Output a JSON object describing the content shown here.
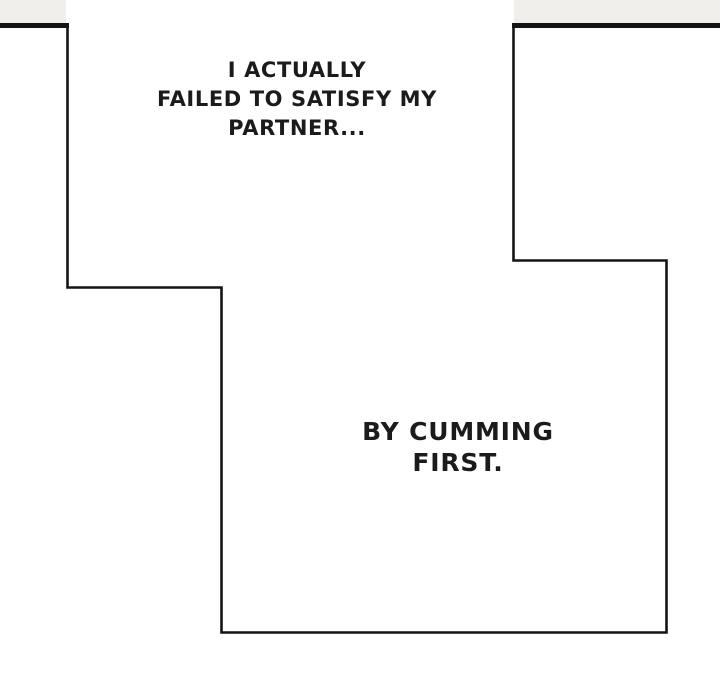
{
  "page": {
    "type": "comic-panel-page"
  },
  "captions": {
    "top": {
      "lines": [
        "I ACTUALLY",
        "FAILED TO SATISFY MY",
        "PARTNER..."
      ]
    },
    "bottom": {
      "lines": [
        "BY CUMMING",
        "FIRST."
      ]
    }
  },
  "colors": {
    "background": "#ffffff",
    "paper_fill": "#f1efeb",
    "line": "#141414",
    "text": "#1b1b1b"
  }
}
